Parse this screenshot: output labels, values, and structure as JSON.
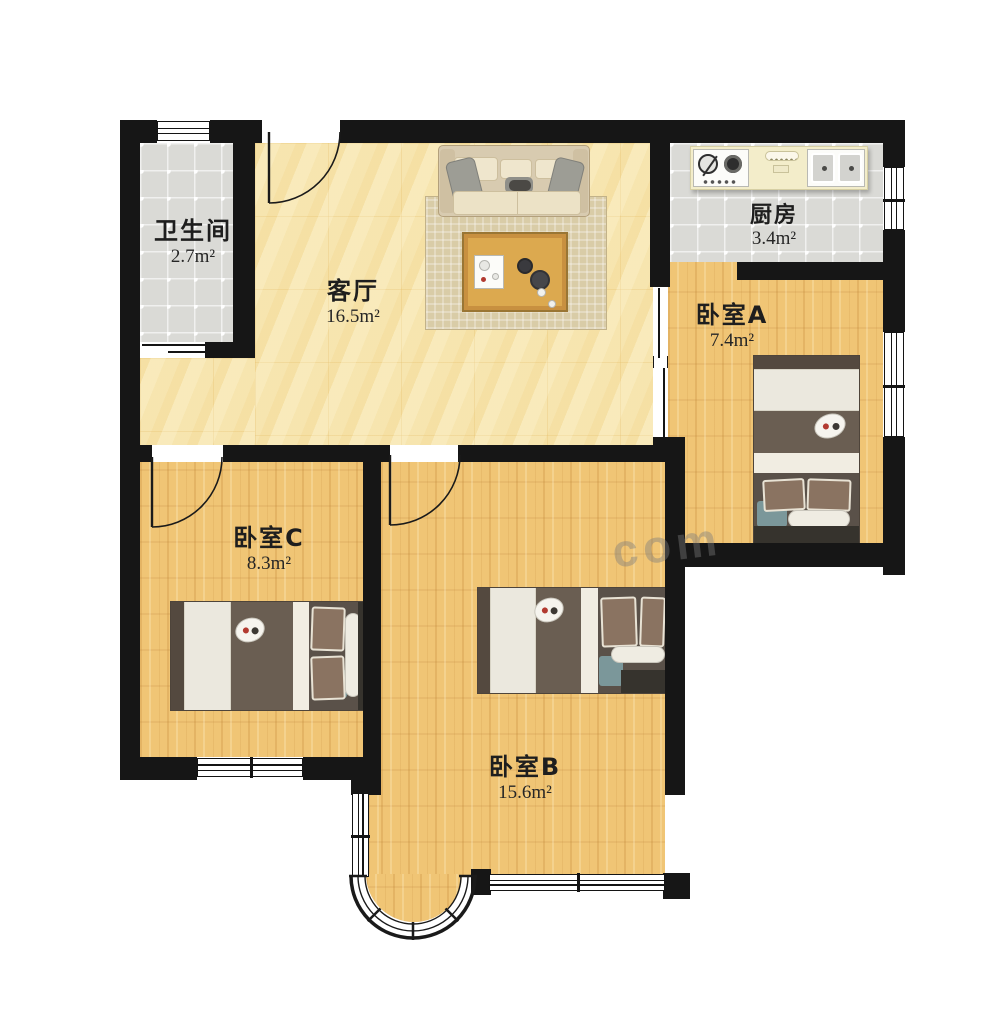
{
  "watermark": {
    "text": "com"
  },
  "rooms": {
    "bathroom": {
      "name": "卫生间",
      "area": "2.7m²"
    },
    "living": {
      "name": "客厅",
      "area": "16.5m²"
    },
    "kitchen": {
      "name": "厨房",
      "area": "3.4m²"
    },
    "bedroom_a": {
      "name": "卧室A",
      "area": "7.4m²"
    },
    "bedroom_c": {
      "name": "卧室C",
      "area": "8.3m²"
    },
    "bedroom_b": {
      "name": "卧室B",
      "area": "15.6m²"
    }
  },
  "colors": {
    "wall": "#161616",
    "wood_floor": "#f0c575",
    "tile_floor": "#dadad6",
    "marble_floor": "#f7e7b4",
    "bed_duvet": "#6a5e52",
    "accent_teal": "#7b979a",
    "flower_red": "#b23a30"
  }
}
